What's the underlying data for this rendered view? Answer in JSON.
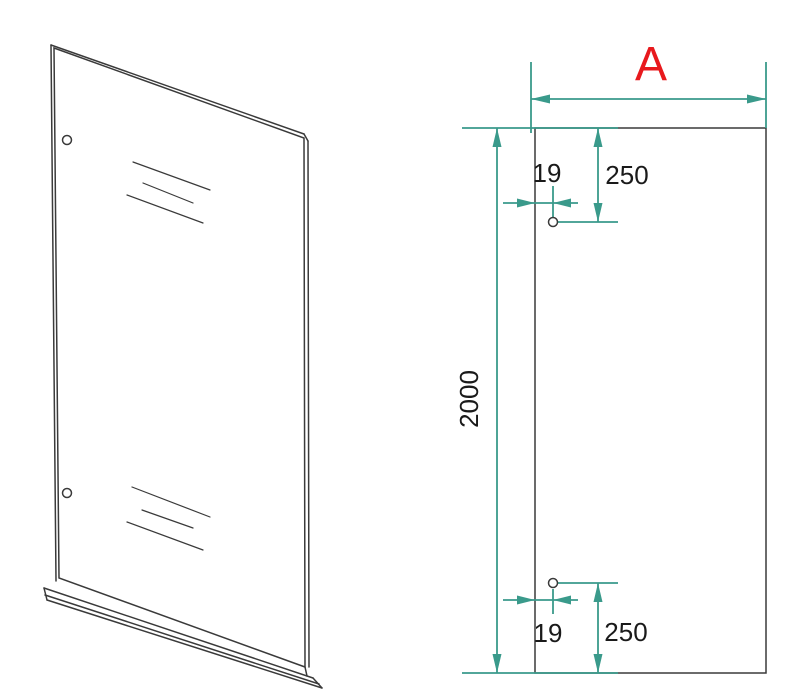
{
  "drawing": {
    "width_label": "A",
    "height_label": "2000",
    "top_hole": {
      "edge_offset": "19",
      "distance_from_top": "250"
    },
    "bottom_hole": {
      "edge_offset": "19",
      "distance_from_bottom": "250"
    }
  },
  "colors": {
    "dimension": "#3a9a8b",
    "outline": "#3a3a3a",
    "accent": "#e8191d",
    "text": "#1a1a1a",
    "background": "#ffffff"
  }
}
